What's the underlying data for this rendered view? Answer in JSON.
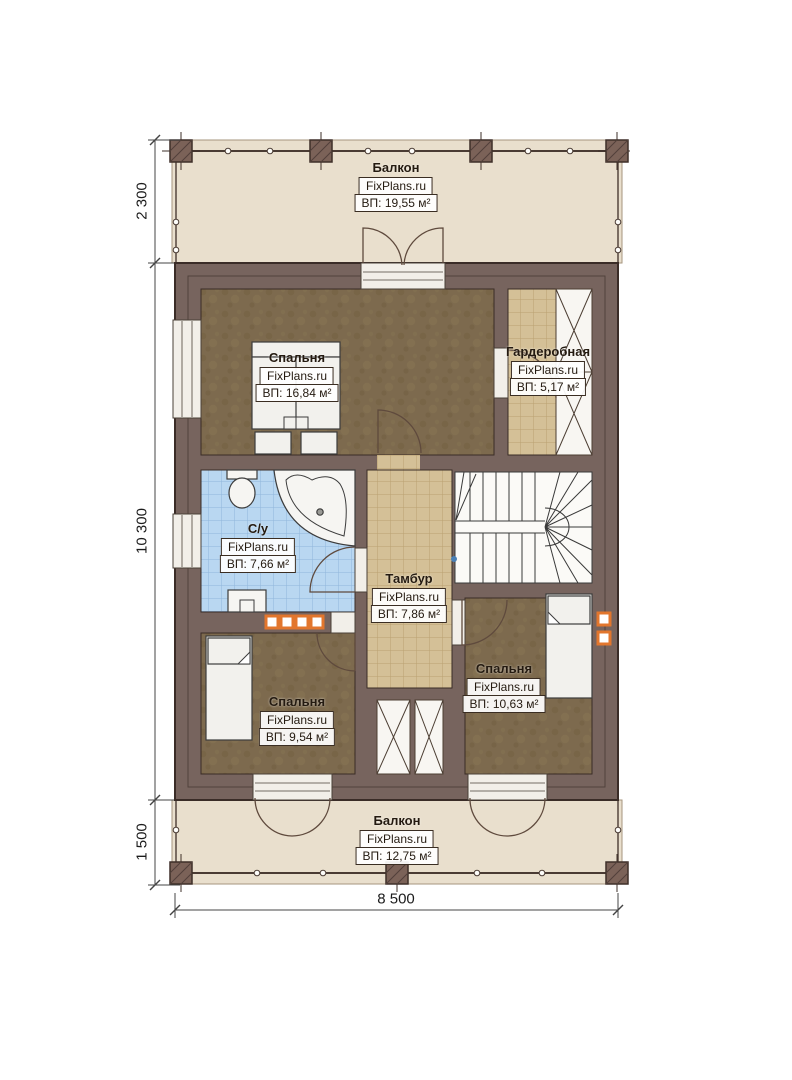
{
  "floor_plan": {
    "brand": "FixPlans.ru",
    "rooms": [
      {
        "key": "balcony_top",
        "name": "Балкон",
        "brand": "FixPlans.ru",
        "area": "ВП: 19,55 м²"
      },
      {
        "key": "bedroom_master",
        "name": "Спальня",
        "brand": "FixPlans.ru",
        "area": "ВП: 16,84 м²"
      },
      {
        "key": "wardrobe",
        "name": "Гардеробная",
        "brand": "FixPlans.ru",
        "area": "ВП: 5,17 м²"
      },
      {
        "key": "bathroom",
        "name": "С/у",
        "brand": "FixPlans.ru",
        "area": "ВП: 7,66 м²"
      },
      {
        "key": "vestibule",
        "name": "Тамбур",
        "brand": "FixPlans.ru",
        "area": "ВП: 7,86 м²"
      },
      {
        "key": "bedroom_left",
        "name": "Спальня",
        "brand": "FixPlans.ru",
        "area": "ВП: 9,54 м²"
      },
      {
        "key": "bedroom_right",
        "name": "Спальня",
        "brand": "FixPlans.ru",
        "area": "ВП: 10,63 м²"
      },
      {
        "key": "balcony_bottom",
        "name": "Балкон",
        "brand": "FixPlans.ru",
        "area": "ВП: 12,75 м²"
      }
    ],
    "dimensions": {
      "top_balcony_depth": "2 300",
      "floor_height": "10 300",
      "bottom_balcony_depth": "1 500",
      "building_width": "8 500"
    },
    "colors": {
      "wall": "#77645e",
      "bedroom_floor": "#7d6a4e",
      "tile_floor": "#d4c097",
      "bath_floor": "#b9d7f1",
      "deck": "#e9dfcd",
      "accent_orange": "#e2762d"
    }
  }
}
